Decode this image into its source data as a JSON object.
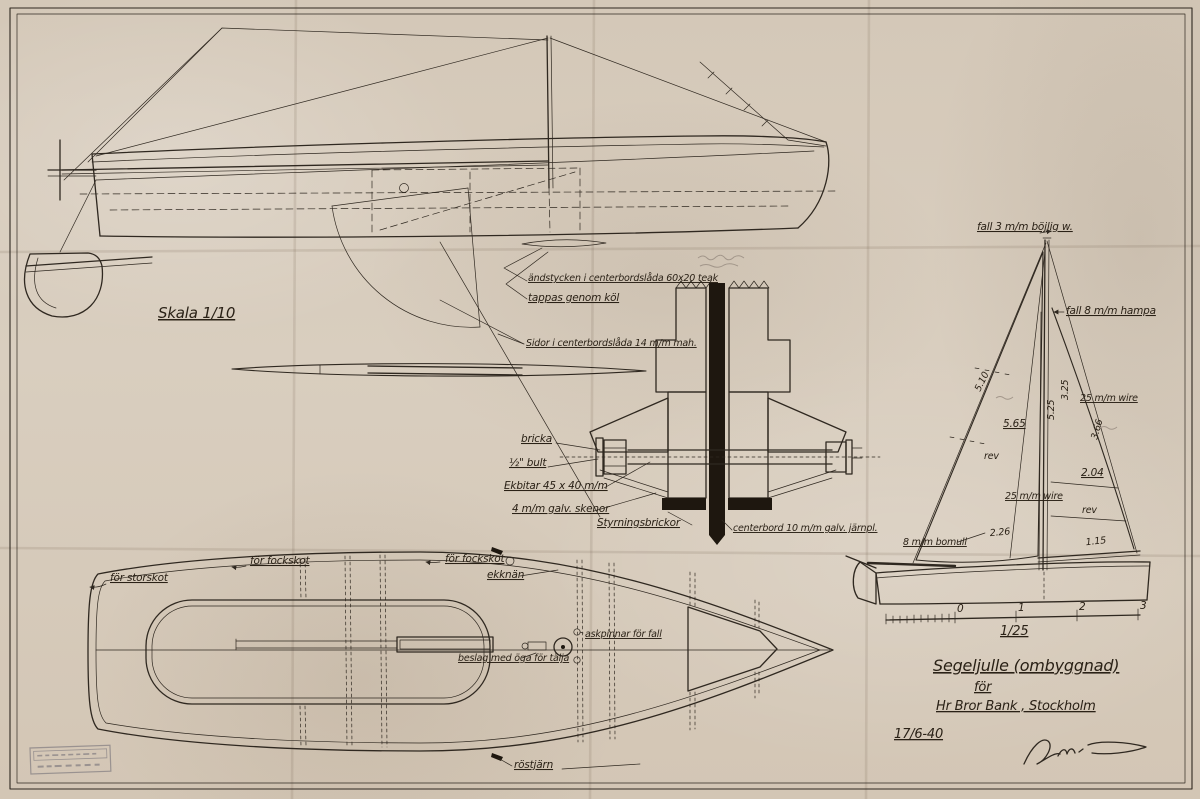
{
  "scale_note": {
    "side": "Skala 1/10"
  },
  "detail": {
    "endpieces": "ändstycken i centerbordslåda 60x20 teak",
    "tappas": "tappas genom köl",
    "sidor": "Sidor i centerbordslåda 14 m/m mah.",
    "bricka": "bricka",
    "bult": "½\" bult",
    "ekbitar": "Ekbitar 45 x 40 m/m",
    "skenor": "4 m/m galv. skenor",
    "styrning": "Styrningsbrickor",
    "centerbord": "centerbord 10 m/m galv. järnpl."
  },
  "sail": {
    "fall_top": "fall 3 m/m böjlig w.",
    "fall_hampa": "fall 8 m/m hampa",
    "mast_upper": "3.25",
    "mast_lower": "5.25",
    "jib_luff": "5.10",
    "jib_mid": "5.65",
    "wire_top": "25 m/m wire",
    "main_leech": "3.66",
    "rev_jib": "rev",
    "main_204": "2.04",
    "wire_left": "25 m/m wire",
    "rev_main": "rev",
    "foot_226": "2.26",
    "foot_115": "1.15",
    "bomull": "8 m/m bomull",
    "scale": "1/25",
    "ticks": [
      "0",
      "1",
      "2",
      "3"
    ]
  },
  "plan": {
    "storskot": "för storskot",
    "fockskot_a": "för fockskot",
    "fockskot_b": "för fockskot",
    "ekknan": "ekknän",
    "askpinnar": "askpinnar för fall",
    "beslag": "beslag med öga för tälja",
    "rostjarn": "röstjärn"
  },
  "title_block": {
    "line1": "Segeljulle (ombyggnad)",
    "line2": "för",
    "line3": "Hr Bror Bank , Stockholm",
    "date": "17/6-40"
  }
}
